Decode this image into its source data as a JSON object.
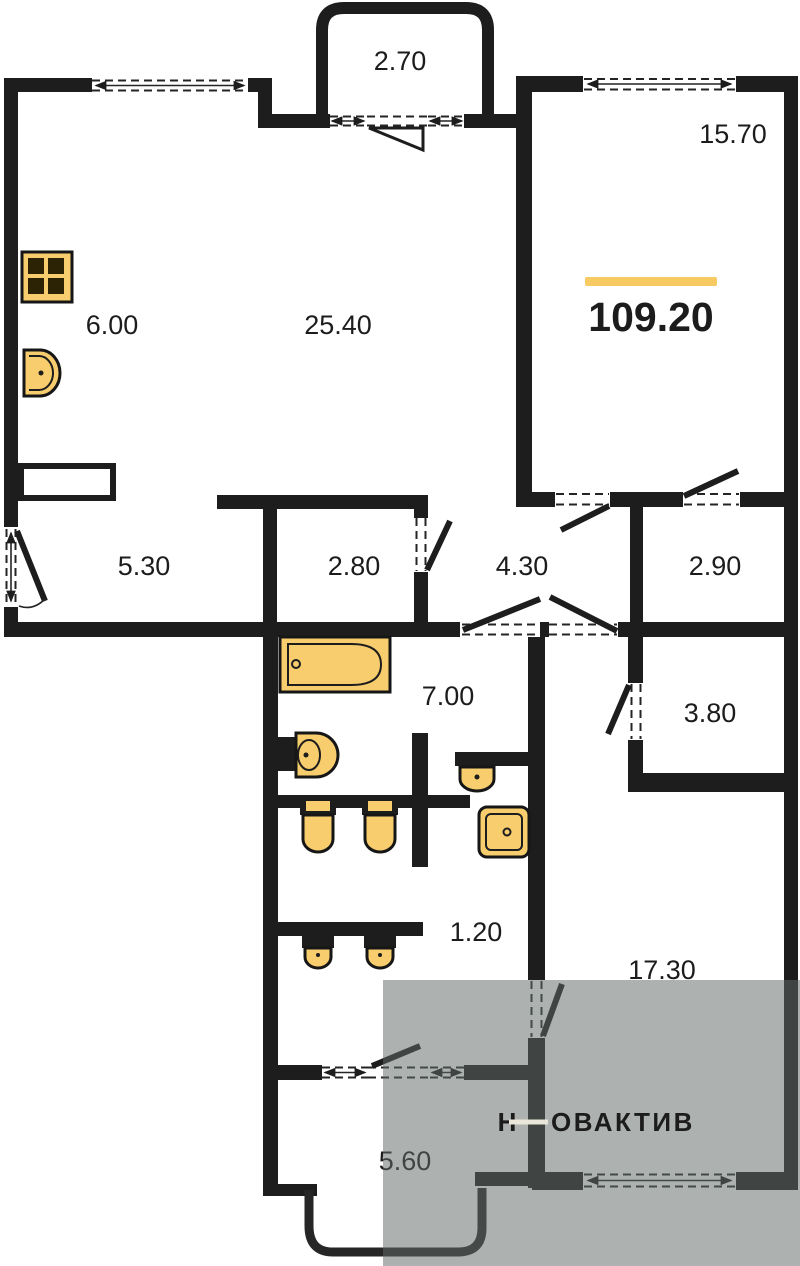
{
  "plan": {
    "type": "apartment-floor-plan",
    "total_area_label": "109.20",
    "watermark": {
      "initial": "Н",
      "rest": "ОВАКТИВ"
    },
    "rooms": {
      "balcony_top": "2.70",
      "room_top_right": "15.70",
      "kitchen": "6.00",
      "living": "25.40",
      "hall": "5.30",
      "storage": "2.80",
      "corridor": "4.30",
      "wardrobe": "2.90",
      "bathroom": "7.00",
      "closet": "3.80",
      "wc": "1.20",
      "bedroom": "17.30",
      "balcony_bottom": "5.60"
    },
    "colors": {
      "wall": "#1d1d1d",
      "fixture_fill": "#f8cd6e",
      "accent_bar": "#f7ca62",
      "overlay": "rgba(97,108,103,0.52)",
      "watermark_text": "#eae6da"
    }
  }
}
